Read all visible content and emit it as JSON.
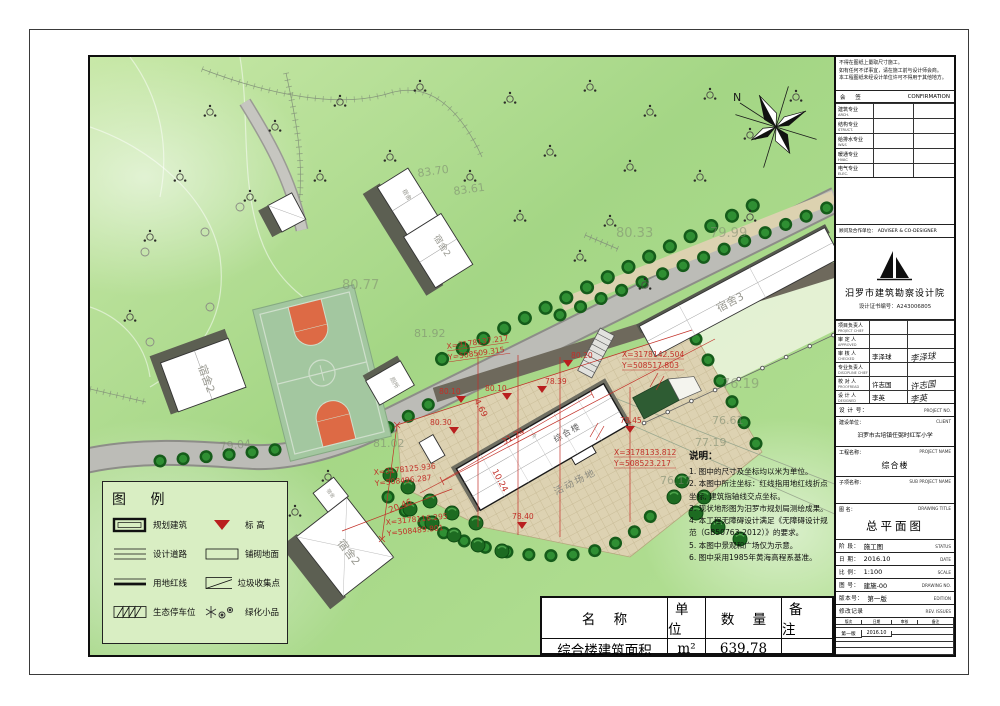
{
  "legend": {
    "title": "图  例",
    "items": [
      {
        "label": "规划建筑"
      },
      {
        "label": "标 高"
      },
      {
        "label": "设计道路"
      },
      {
        "label": "铺砌地面"
      },
      {
        "label": "用地红线"
      },
      {
        "label": "垃圾收集点"
      },
      {
        "label": "生态停车位"
      },
      {
        "label": "绿化小品"
      }
    ]
  },
  "notes": {
    "title": "说明：",
    "items": [
      "1. 图中的尺寸及坐标均以米为单位。",
      "2. 本图中所注坐标：红线指用地红线折点坐标, 建筑指轴线交点坐标。",
      "3. 现状地形图为汨罗市规划局测绘成果。",
      "4. 本工程无障碍设计满足《无障碍设计规范（GB50763-2012）》的要求。",
      "5. 本图中景观和广场仅为示意。",
      "6. 图中采用1985年黄海高程系基准。"
    ]
  },
  "area_table": {
    "headers": [
      "名    称",
      "单 位",
      "数    量",
      "备  注"
    ],
    "row": {
      "name": "综合楼建筑面积",
      "unit": "m²",
      "qty": "639.78",
      "remark": ""
    }
  },
  "titleblock": {
    "warnings": [
      "不得在图纸上量取尺寸施工。",
      "如有任何不详事宜，请在施工前与设计师会商。",
      "本工程图纸未经设计单位许可不得用于其他地方。"
    ],
    "confirmation": {
      "cn": "会 签",
      "en": "CONFIRMATION",
      "rows": [
        {
          "cn": "建筑专业",
          "en": "ARCH."
        },
        {
          "cn": "结构专业",
          "en": "STRUCT."
        },
        {
          "cn": "给排水专业",
          "en": "W&S"
        },
        {
          "cn": "暖通专业",
          "en": "HVAC"
        },
        {
          "cn": "电气专业",
          "en": "ELEC."
        }
      ]
    },
    "cooperation": {
      "cn": "顾问及合作单位：",
      "en": "ADVISER & CO-DESIGNER"
    },
    "institute": {
      "name": "汨罗市建筑勘察设计院",
      "license": "设计证书编号：A243006805"
    },
    "signatures": [
      {
        "cn": "项目负责人",
        "en": "PROJECT CHIEF",
        "name": "",
        "script": ""
      },
      {
        "cn": "审 定 人",
        "en": "APPROVED",
        "name": "",
        "script": ""
      },
      {
        "cn": "审 核 人",
        "en": "CHECKED",
        "name": "李泽球",
        "script": "李泽球"
      },
      {
        "cn": "专业负责人",
        "en": "DISCIPLINE CHIEF",
        "name": "",
        "script": ""
      },
      {
        "cn": "校 对 人",
        "en": "PROOFREAD",
        "name": "许志国",
        "script": "许志国"
      },
      {
        "cn": "设 计 人",
        "en": "DESIGNED",
        "name": "李英",
        "script": "李英"
      }
    ],
    "project_no": {
      "cn": "设 计 号：",
      "en": "PROJECT NO.",
      "value": ""
    },
    "client": {
      "cn": "建设单位：",
      "en": "CLIENT",
      "value": "汨罗市古培镇任弼时红军小学"
    },
    "project_name": {
      "cn": "工程名称：",
      "en": "PROJECT NAME",
      "value": "综合楼"
    },
    "sub_project": {
      "cn": "子项名称：",
      "en": "SUB PROJECT NAME",
      "value": ""
    },
    "drawing_title": {
      "cn": "图 名：",
      "en": "DRAWING TITLE",
      "value": "总平面图"
    },
    "status": {
      "cn": "阶 段：",
      "en": "STATUS",
      "value": "施工图"
    },
    "date": {
      "cn": "日 期：",
      "en": "DATE",
      "value": "2016.10"
    },
    "scale": {
      "cn": "比 例：",
      "en": "SCALE",
      "value": "1:100"
    },
    "drawing_no": {
      "cn": "图 号：",
      "en": "DRAWING NO.",
      "value": "建施-00"
    },
    "edition": {
      "cn": "版本号：",
      "en": "EDITION",
      "value": "第一版"
    },
    "revision": {
      "cn": "修改记录",
      "en": "REV. ISSUES",
      "headers": [
        "版次",
        "日期",
        "审核",
        "备注"
      ],
      "row": [
        "第一版",
        "2016.10",
        "",
        ""
      ]
    }
  },
  "map": {
    "north_label": "N",
    "building_labels": {
      "dorm_top": "宿舍2",
      "dorm_top2": "宿舍",
      "dorm_left": "宿舍2",
      "dorm3": "宿舍3",
      "main": "综合楼",
      "main_floors": "3F",
      "dorm_bottom": "宿舍2",
      "wing": "宿舍",
      "small": "厕所",
      "playground": "活动场地"
    },
    "levels_gray": [
      "83.70",
      "83.61",
      "80.77",
      "80.33",
      "79.99",
      "81.92",
      "81.02",
      "79.04",
      "76.19",
      "76.61",
      "77.19",
      "76.17"
    ],
    "levels_red": [
      "80.20",
      "80.10",
      "80.10",
      "80.30",
      "78.39",
      "78.45",
      "78.40"
    ],
    "coords": [
      {
        "x": "X=3178137.217",
        "y": "Y=508509.315"
      },
      {
        "x": "X=3178142.504",
        "y": "Y=508517.803"
      },
      {
        "x": "X=3178133.812",
        "y": "Y=508523.217"
      },
      {
        "x": "X=3178125.936",
        "y": "Y=508496.287"
      },
      {
        "x": "X=3178116.295",
        "y": "Y=508489.801"
      }
    ],
    "dims": [
      "31.24",
      "10.24",
      "20.46",
      "4.69"
    ]
  }
}
